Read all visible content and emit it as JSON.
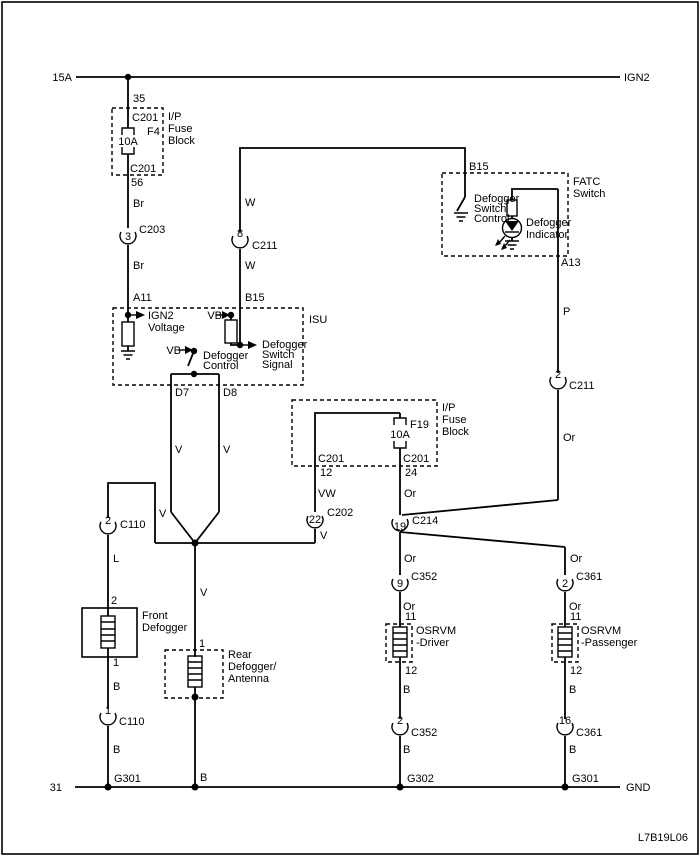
{
  "page": {
    "doc_code": "L7B19L06",
    "ink_color": "#000000",
    "paper_color": "#ffffff"
  },
  "power_rail": {
    "rating": "15A",
    "name": "IGN2"
  },
  "ground_rail": {
    "terminal": "31",
    "name": "GND"
  },
  "fuse_block_top": {
    "label": [
      "I/P",
      "Fuse",
      "Block"
    ],
    "pin_in": "35",
    "connector_top": "C201",
    "fuse_name": "F4",
    "fuse_rating": "10A",
    "connector_bottom": "C201",
    "pin_out": "56"
  },
  "fuse_block_mid": {
    "label": [
      "I/P",
      "Fuse",
      "Block"
    ],
    "fuse_name": "F19",
    "fuse_rating": "10A",
    "connector_left": "C201",
    "pin_left": "12",
    "connector_right": "C201",
    "pin_right": "24"
  },
  "isu": {
    "name": "ISU",
    "pin_a11": "A11",
    "pin_b15": "B15",
    "pin_d7": "D7",
    "pin_d8": "D8",
    "ign2_voltage": [
      "IGN2",
      "Voltage"
    ],
    "vb_pullup": "VB",
    "vb_control": "VB",
    "switch_signal": [
      "Defogger",
      "Switch",
      "Signal"
    ],
    "control": [
      "Defogger",
      "Control"
    ]
  },
  "fatc": {
    "name": [
      "FATC",
      "Switch"
    ],
    "pin_b15": "B15",
    "pin_a13": "A13",
    "switch_control": [
      "Defogger",
      "Switch",
      "Control"
    ],
    "indicator": [
      "Defogger",
      "Indicator"
    ]
  },
  "front_defogger": {
    "name": [
      "Front",
      "Defogger"
    ],
    "pin_top": "2",
    "pin_bottom": "1"
  },
  "rear_defogger": {
    "name": [
      "Rear",
      "Defogger/",
      "Antenna"
    ],
    "pin_top": "1"
  },
  "osrvm_driver": {
    "name": [
      "OSRVM",
      "-Driver"
    ],
    "pin_top": "11",
    "pin_bottom": "12"
  },
  "osrvm_passenger": {
    "name": [
      "OSRVM",
      "-Passenger"
    ],
    "pin_top": "11",
    "pin_bottom": "12"
  },
  "connectors": {
    "c203": {
      "pin": "3",
      "name": "C203"
    },
    "c211_8": {
      "pin": "8",
      "name": "C211"
    },
    "c211_2": {
      "pin": "2",
      "name": "C211"
    },
    "c110_2": {
      "pin": "2",
      "name": "C110"
    },
    "c110_1": {
      "pin": "1",
      "name": "C110"
    },
    "c202": {
      "pin": "22",
      "name": "C202"
    },
    "c214": {
      "pin": "19",
      "name": "C214"
    },
    "c352_9": {
      "pin": "9",
      "name": "C352"
    },
    "c352_2": {
      "pin": "2",
      "name": "C352"
    },
    "c361_2": {
      "pin": "2",
      "name": "C361"
    },
    "c361_16": {
      "pin": "16",
      "name": "C361"
    }
  },
  "wires": {
    "br_upper": "Br",
    "br_lower": "Br",
    "w_upper": "W",
    "w_lower": "W",
    "p": "P",
    "or_fatc": "Or",
    "v_d7": "V",
    "v_d8": "V",
    "vw": "VW",
    "v_c202": "V",
    "or_f19": "Or",
    "v_left": "V",
    "l": "L",
    "b_front_upper": "B",
    "b_front_lower": "B",
    "v_rear": "V",
    "b_rear": "B",
    "or_driver_upper": "Or",
    "or_driver_lower": "Or",
    "b_driver_upper": "B",
    "b_driver_lower": "B",
    "or_passenger_upper": "Or",
    "or_passenger_lower": "Or",
    "b_passenger_upper": "B",
    "b_passenger_lower": "B"
  },
  "grounds": {
    "g301_left": "G301",
    "g302": "G302",
    "g301_right": "G301"
  }
}
